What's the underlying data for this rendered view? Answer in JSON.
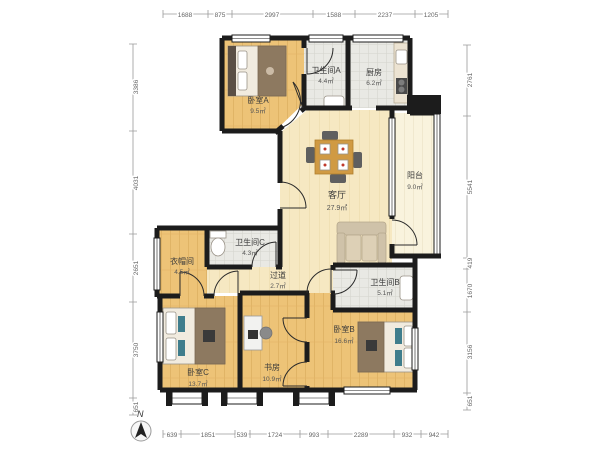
{
  "rooms": {
    "bedroom_a": {
      "name": "卧室A",
      "area": "9.5㎡"
    },
    "bath_a": {
      "name": "卫生间A",
      "area": "4.4㎡"
    },
    "kitchen": {
      "name": "厨房",
      "area": "6.2㎡"
    },
    "living": {
      "name": "客厅",
      "area": "27.9㎡"
    },
    "balcony": {
      "name": "阳台",
      "area": "9.0㎡"
    },
    "bath_c": {
      "name": "卫生间C",
      "area": "4.3㎡"
    },
    "closet": {
      "name": "衣帽间",
      "area": "4.5㎡"
    },
    "hallway": {
      "name": "过道",
      "area": "2.7㎡"
    },
    "bath_b": {
      "name": "卫生间B",
      "area": "5.1㎡"
    },
    "bedroom_b": {
      "name": "卧室B",
      "area": "16.6㎡"
    },
    "study": {
      "name": "书房",
      "area": "10.9㎡"
    },
    "bedroom_c": {
      "name": "卧室C",
      "area": "13.7㎡"
    }
  },
  "dimensions": {
    "top": [
      "1688",
      "875",
      "2997",
      "1588",
      "2237",
      "1205"
    ],
    "bottom": [
      "639",
      "1851",
      "539",
      "1724",
      "993",
      "2289",
      "932",
      "942"
    ],
    "left": [
      "3386",
      "4031",
      "2651",
      "3750",
      "651"
    ],
    "right": [
      "2761",
      "5541",
      "419",
      "1670",
      "3156",
      "651"
    ]
  },
  "compass": {
    "label": "N"
  },
  "colors": {
    "wall": "#1c1c1c",
    "wood_floor": "#edc377",
    "living_floor": "#f6e8c2",
    "tile_floor": "#e9e9e4",
    "balcony_floor": "#f9f3dd"
  }
}
